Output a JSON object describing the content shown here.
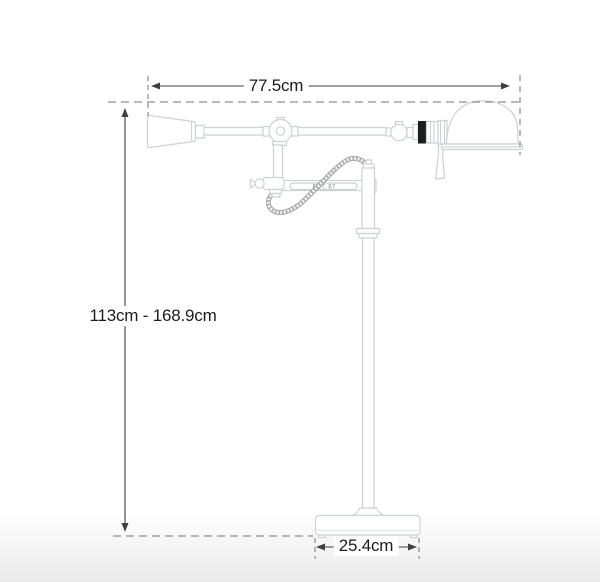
{
  "diagram": {
    "title": "floor-lamp-dimension-diagram",
    "brand_mark": "EST. 67",
    "dimensions": {
      "width": "77.5cm",
      "height_range": "113cm - 168.9cm",
      "base_width": "25.4cm"
    },
    "colors": {
      "line_art": "#ced2d2",
      "dimension_line": "#3f3f3f",
      "dashed_guide": "#8f8f8f",
      "label_text": "#1c1c1c",
      "socket_band": "#1f1f1f",
      "cord": "#9a9a9a",
      "background_fade_bottom": "#eaeaea"
    }
  }
}
